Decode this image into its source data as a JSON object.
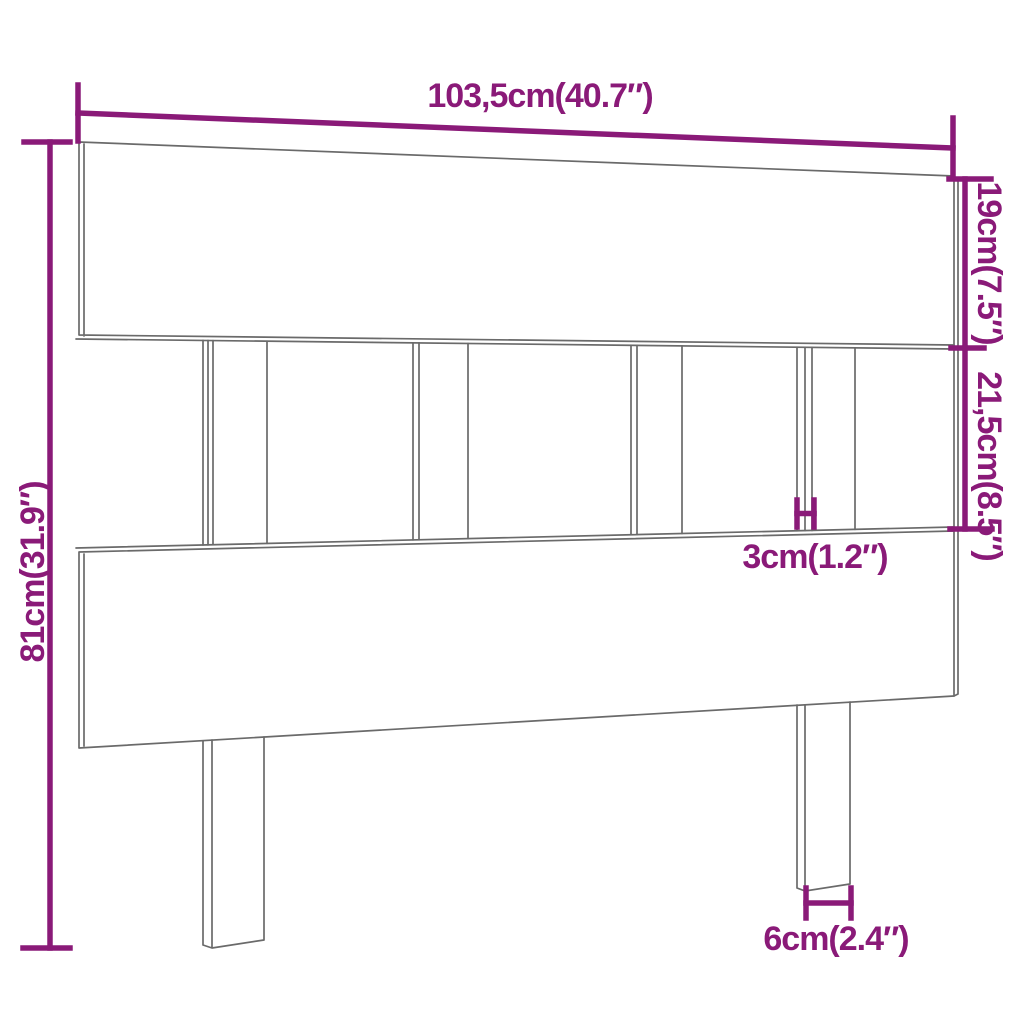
{
  "diagram": {
    "kind": "furniture-dimension-drawing",
    "subject": "slatted wooden bed headboard with two legs",
    "background_color": "#ffffff",
    "outline_color": "#6a6a6a",
    "dimension_color": "#8a1a78",
    "labels": {
      "width": "103,5cm(40.7″)",
      "top_board_height": "19cm(7.5″)",
      "middle_section_height": "21,5cm(8.5″)",
      "overall_height": "81cm(31.9″)",
      "slat_thickness": "3cm(1.2″)",
      "leg_width": "6cm(2.4″)"
    },
    "values": {
      "width_cm": 103.5,
      "width_in": 40.7,
      "top_board_height_cm": 19,
      "top_board_height_in": 7.5,
      "middle_section_height_cm": 21.5,
      "middle_section_height_in": 8.5,
      "overall_height_cm": 81,
      "overall_height_in": 31.9,
      "slat_thickness_cm": 3,
      "slat_thickness_in": 1.2,
      "leg_width_cm": 6,
      "leg_width_in": 2.4
    }
  }
}
